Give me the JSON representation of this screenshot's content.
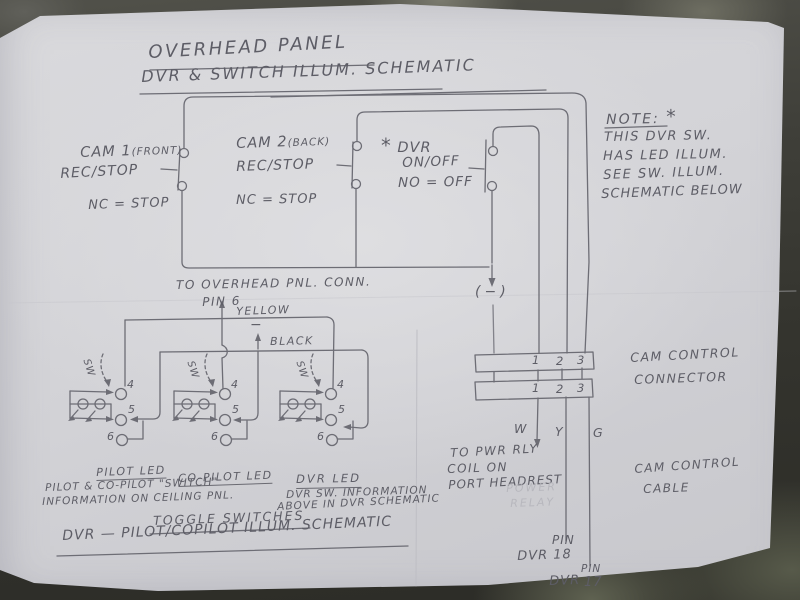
{
  "title": {
    "line1": "OVERHEAD PANEL",
    "line2": "DVR & SWITCH ILLUM. SCHEMATIC"
  },
  "dvr_schematic": {
    "cam1": {
      "name": "CAM 1",
      "variant": "(FRONT)",
      "function": "REC/STOP",
      "contact": "NC = STOP"
    },
    "cam2": {
      "name": "CAM 2",
      "variant": "(BACK)",
      "function": "REC/STOP",
      "contact": "NC = STOP"
    },
    "dvr": {
      "star": "*",
      "name": "DVR",
      "function": "ON/OFF",
      "contact": "NO = OFF"
    },
    "ground": "(−)",
    "note": {
      "heading": "NOTE:",
      "star": "*",
      "line1": "THIS DVR SW.",
      "line2": "HAS LED ILLUM.",
      "line3": "SEE SW. ILLUM.",
      "line4": "SCHEMATIC BELOW"
    }
  },
  "cam_control": {
    "connector_row1": [
      "1",
      "2",
      "3"
    ],
    "connector_row2": [
      "1",
      "2",
      "3"
    ],
    "connector_label1": "CAM CONTROL",
    "connector_label2": "CONNECTOR",
    "cable_label1": "CAM CONTROL",
    "cable_label2": "CABLE",
    "wire_w": "W",
    "wire_y": "Y",
    "wire_g": "G",
    "pwr_line1": "TO PWR RLY",
    "pwr_line2": "COIL ON",
    "pwr_line3": "PORT HEADREST",
    "ghost_line1": "POWER",
    "ghost_line2": "RELAY",
    "pin18_pin": "PIN",
    "pin18": "DVR 18",
    "pin17_dvr": "DVR",
    "pin17_pin": "PIN",
    "pin17_num": "17"
  },
  "illum_schematic": {
    "conn_note": "TO OVERHEAD PNL. CONN.",
    "pin6": "PIN 6",
    "yellow": "YELLOW",
    "minus": "−",
    "black": "BLACK",
    "sw": "SW",
    "pin4": "4",
    "pin5": "5",
    "pin6_num": "6",
    "led1": "PILOT LED",
    "led2": "CO-PILOT LED",
    "led3": "DVR LED",
    "pilot_note1": "PILOT & CO-PILOT \"SWITCH\"",
    "pilot_note2": "INFORMATION ON CEILING PNL.",
    "dvr_note1": "DVR SW. INFORMATION",
    "dvr_note2": "ABOVE IN DVR SCHEMATIC",
    "footer1": "TOGGLE SWITCHES",
    "footer2": "DVR — PILOT/COPILOT ILLUM. SCHEMATIC"
  }
}
